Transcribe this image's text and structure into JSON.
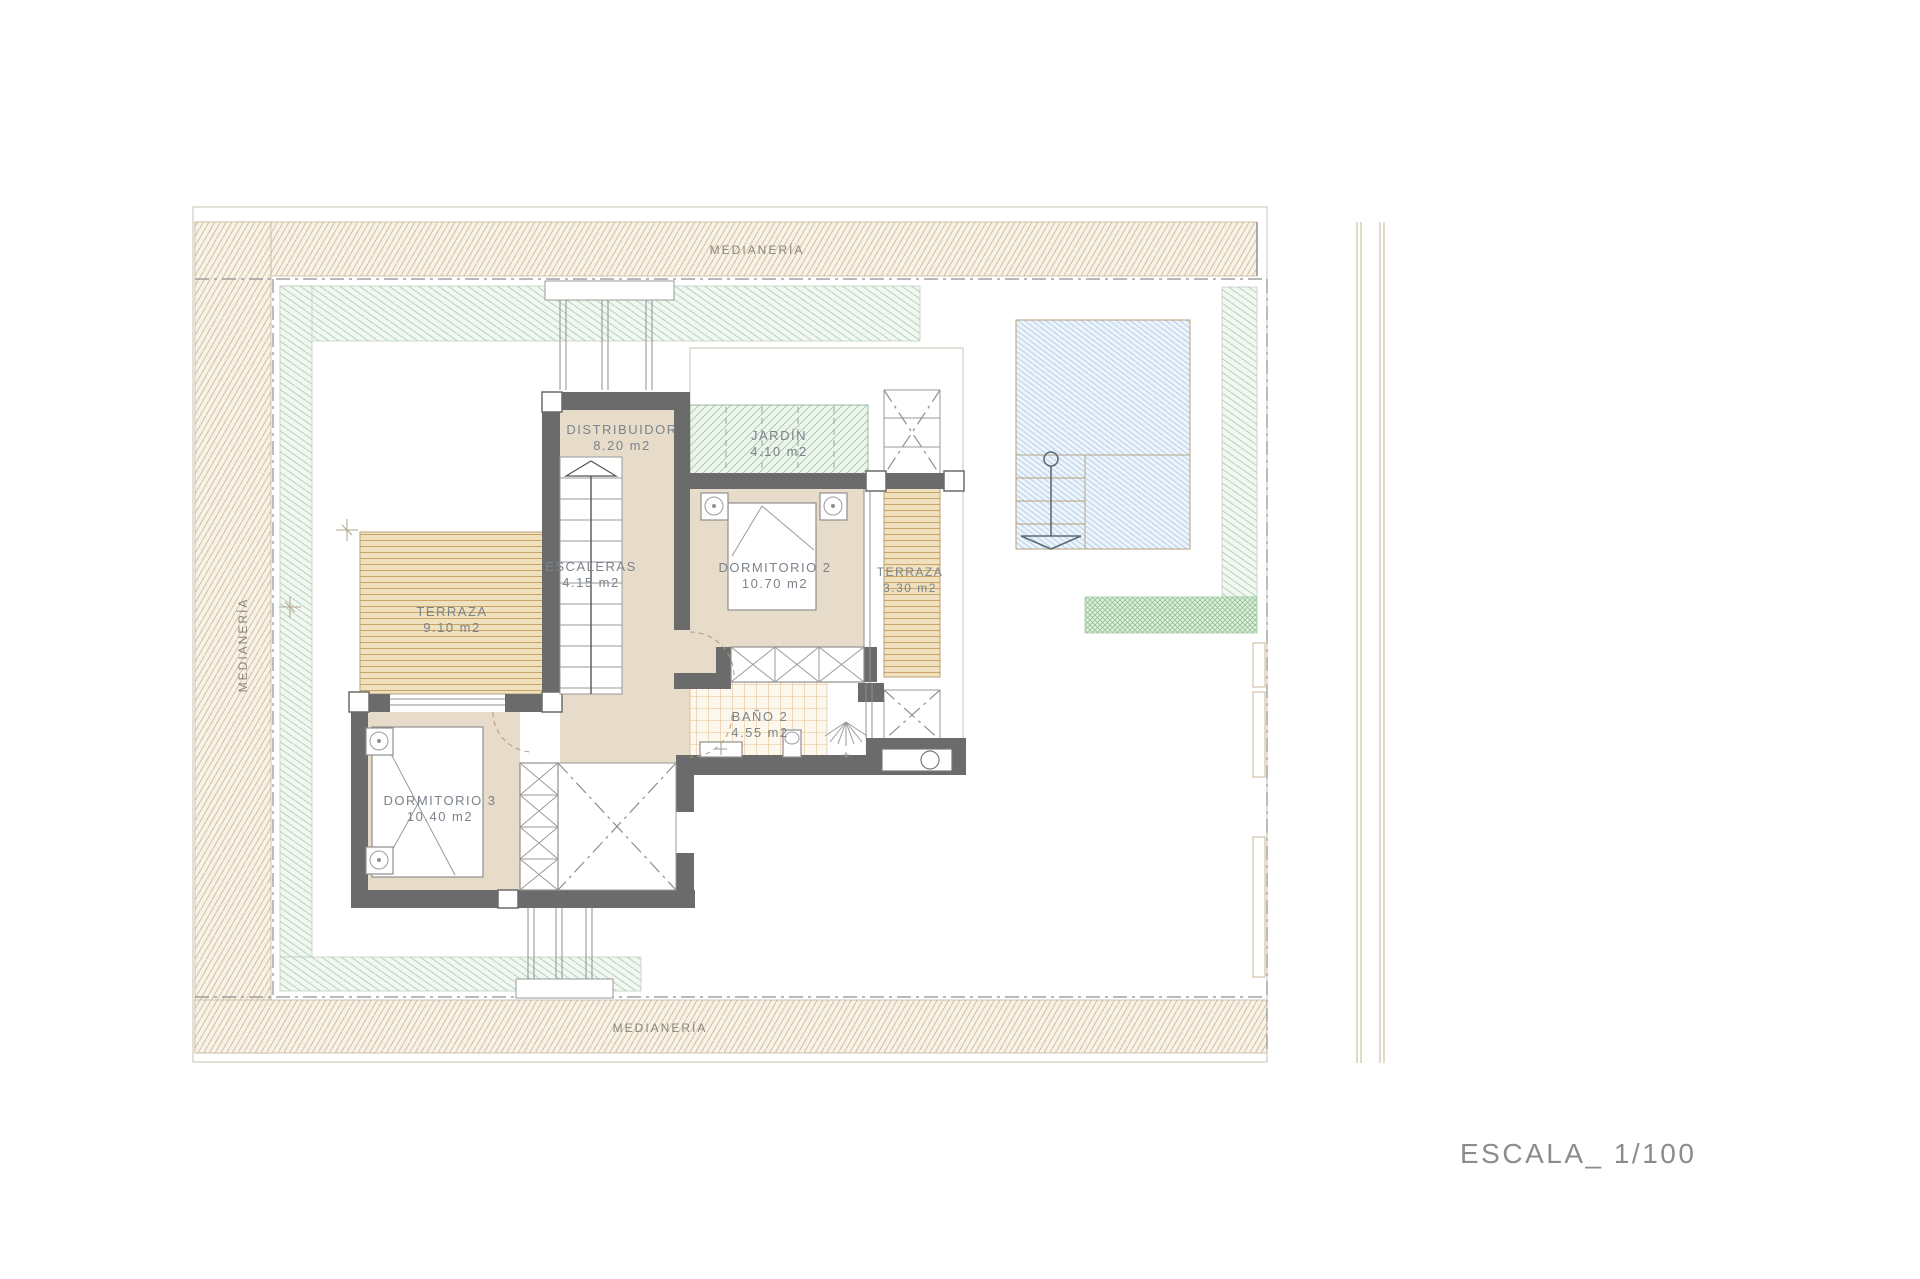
{
  "plan": {
    "title_block": {
      "scale_label": "ESCALA_ 1/100"
    },
    "boundary": {
      "top_label": "MEDIANERÍA",
      "bottom_label": "MEDIANERÍA",
      "left_label": "MEDIANERÍA"
    },
    "rooms": [
      {
        "id": "distribuidor",
        "name": "DISTRIBUIDOR",
        "area": "8.20 m2"
      },
      {
        "id": "jardin",
        "name": "JARDÍN",
        "area": "4.10 m2"
      },
      {
        "id": "dormitorio-2",
        "name": "DORMITORIO 2",
        "area": "10.70 m2"
      },
      {
        "id": "terraza-2",
        "name": "TERRAZA",
        "area": "3.30 m2"
      },
      {
        "id": "escaleras",
        "name": "ESCALERAS",
        "area": "4.15 m2"
      },
      {
        "id": "terraza-1",
        "name": "TERRAZA",
        "area": "9.10 m2"
      },
      {
        "id": "bano-2",
        "name": "BAÑO 2",
        "area": "4.55 m2"
      },
      {
        "id": "dormitorio-3",
        "name": "DORMITORIO 3",
        "area": "10.40 m2"
      }
    ],
    "colors": {
      "wall": "#6b6b6b",
      "room_floor": "#e7dbc9",
      "deck_stripe": "#c9a368",
      "site_hatch": "#cdb894",
      "setback_green": "#a6cbae",
      "pool_blue": "#a9c6e2",
      "bath_tile": "#dcab6e",
      "label_text": "#7b838c"
    }
  }
}
